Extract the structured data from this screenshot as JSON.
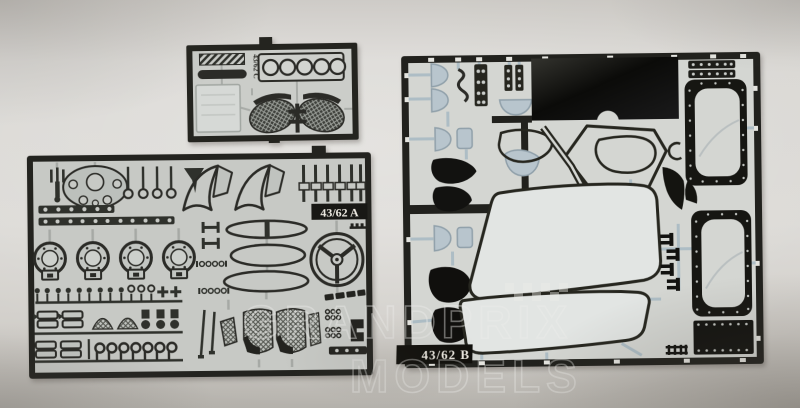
{
  "scene": {
    "type": "photograph",
    "subject": "Three photo-etched metal detail sheets (frets) for a 1/43 scale model car kit laid on a light grey surface",
    "background_hex": "#d3d0cb"
  },
  "watermark": {
    "line1": "GRANDPRIX",
    "line2": "MODELS",
    "motif": "checkered-flag"
  },
  "fret_c": {
    "label": "43/62 C",
    "parts": [
      "hatched-grille-strip",
      "dark-trim-bar",
      "etched-panel-plate",
      "gauge-strip-five-holes",
      "wiper-arm-left",
      "wiper-arm-right",
      "mesh-oval-left",
      "mesh-oval-right",
      "center-bracket"
    ]
  },
  "fret_a": {
    "label": "43/62 A",
    "parts": [
      "fork-lever",
      "bulkhead-plate-with-holes",
      "pin-row",
      "wing-brace-pair",
      "zipper-pull-set",
      "studded-bars",
      "brake-drum-faces",
      "h-clips",
      "ellipse-rings",
      "steering-wheel",
      "small-pin-row",
      "seatbelt-buckles",
      "mesh-fans",
      "bottle-fittings",
      "j-hooks",
      "wiper-arms",
      "pedal-pad",
      "mesh-seat-left",
      "mesh-seat-right",
      "rivet-grids",
      "g-bracket",
      "studded-bar-small"
    ]
  },
  "fret_b": {
    "label": "43/62 B",
    "parts": [
      "window-film-domes",
      "zigzag-bracket",
      "riveted-strips",
      "acetate-film-rectangle",
      "door-window-frame-upper",
      "door-window-frame-lower",
      "side-window-seal-ring",
      "quarter-window-ring",
      "window-seal-diamond",
      "c-clip",
      "corner-gussets",
      "black-teardrops",
      "black-kidney-shapes",
      "windscreen-frame",
      "rear-window-frame",
      "comb-brackets",
      "riveted-plate",
      "ladder-bracket"
    ]
  },
  "colors": {
    "sheet_silver": "#c7c9c5",
    "sheet_light": "#d4d6d2",
    "etch_dark": "#26261f",
    "film_black": "#0c0c0a",
    "film_blue": "#b8c5cd",
    "sprue_blue": "#adbdc5",
    "label_text": "#ece9e1"
  }
}
